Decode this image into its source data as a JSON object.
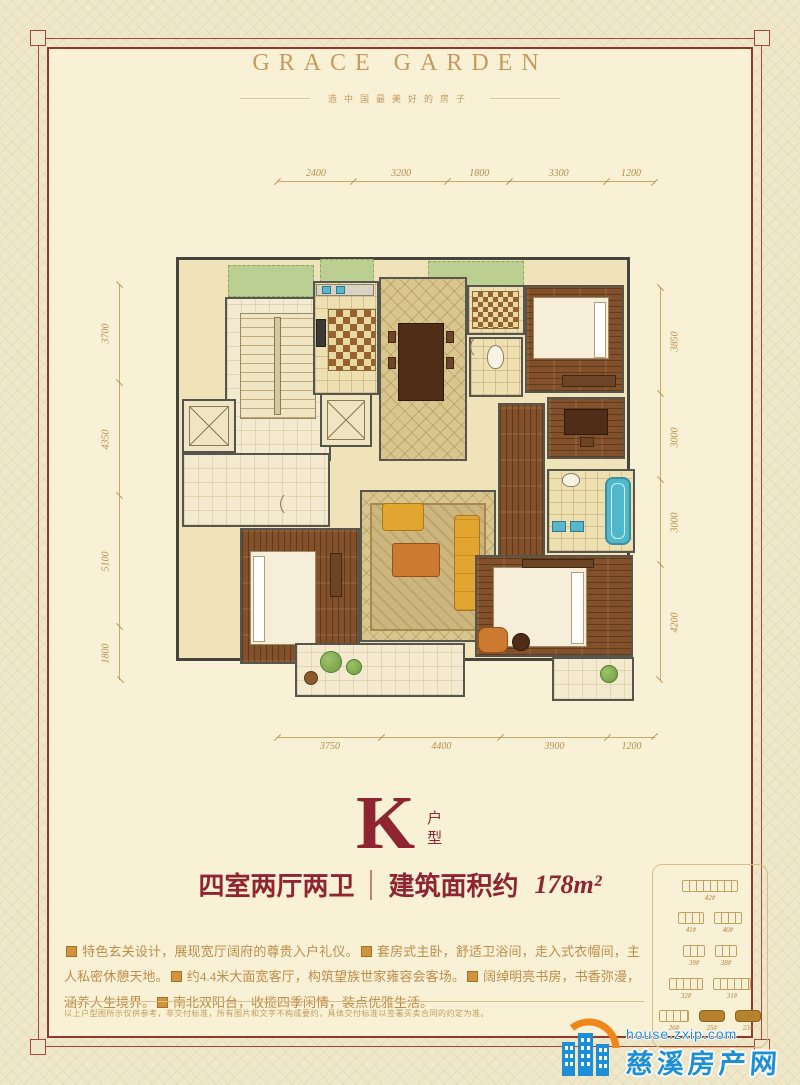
{
  "header": {
    "title": "GRACE GARDEN",
    "subtitle": "造中国最美好的房子"
  },
  "unit": {
    "letter": "K",
    "type": "户型",
    "rooms": "四室两厅两卫",
    "area_label": "建筑面积约",
    "area_value": "178m²"
  },
  "dimensions": {
    "top": [
      2400,
      3200,
      1800,
      3300,
      1200
    ],
    "bottom": [
      3750,
      4400,
      3900,
      1200
    ],
    "left": [
      3700,
      4350,
      5100,
      1800
    ],
    "right": [
      3850,
      3000,
      3000,
      4200
    ]
  },
  "description": {
    "items": [
      "特色玄关设计，展现宽厅阔府的尊贵入户礼仪。",
      "套房式主卧，舒适卫浴间，走入式衣帽间，主人私密休憩天地。",
      "约4.4米大面宽客厅，构筑望族世家雍容会客场。",
      "阔绰明亮书房，书香弥漫，涵养人生境界。",
      "南北双阳台，收揽四季闲情，装点优雅生活。"
    ]
  },
  "disclaimer": "以上户型图所示仅供参考，非交付标准，所有图片和文字不构成要约，具体交付标准以签署买卖合同的约定为准。",
  "site_key": {
    "rows": [
      [
        {
          "label": "42#",
          "w": 56
        }
      ],
      [
        {
          "label": "41#",
          "w": 26
        },
        {
          "label": "40#",
          "w": 28
        }
      ],
      [
        {
          "label": "39#",
          "w": 22
        },
        {
          "label": "38#",
          "w": 22
        }
      ],
      [
        {
          "label": "32#",
          "w": 34
        },
        {
          "label": "31#",
          "w": 38
        }
      ],
      [
        {
          "label": "26#",
          "w": 30
        },
        {
          "label": "25#",
          "w": 26,
          "filled": true
        },
        {
          "label": "23#",
          "w": 26,
          "filled": true
        }
      ]
    ]
  },
  "watermark": {
    "url": "house.zxip.com",
    "name": "慈溪房产网"
  },
  "colors": {
    "accent_red": "#8e2531",
    "frame_red": "#93392c",
    "gold": "#c59a5e",
    "wm_blue": "#1d8fd6",
    "wm_orange": "#f08519",
    "highlight_building": "#b5822e"
  }
}
